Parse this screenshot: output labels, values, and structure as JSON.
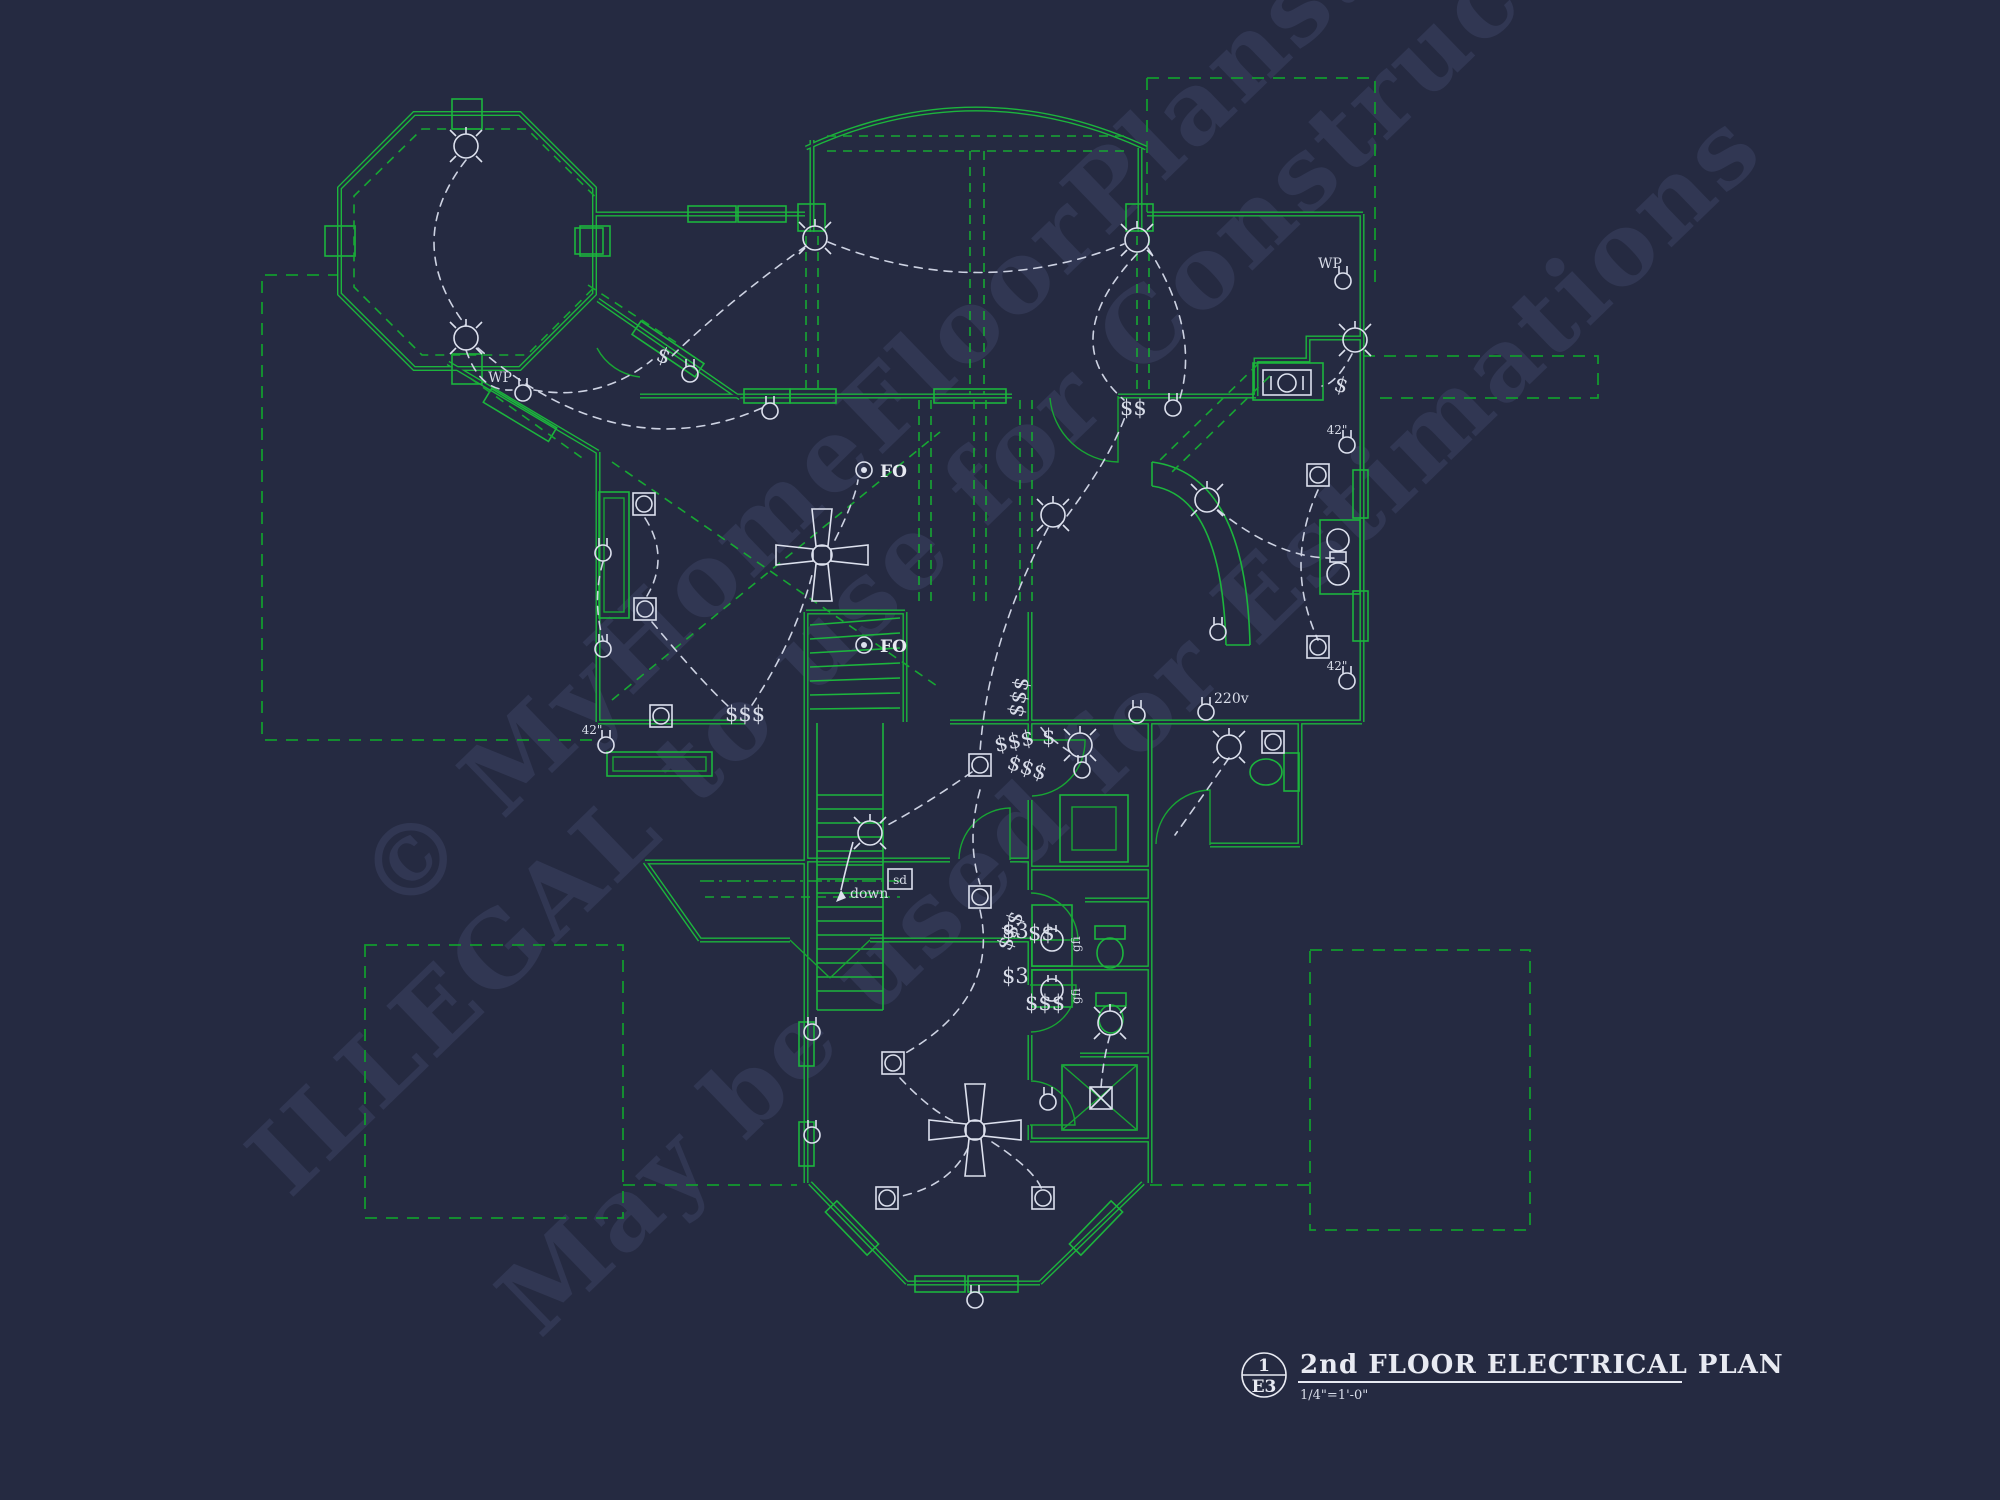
{
  "drawing": {
    "background_color": "#252a41",
    "wall_color": "#1cb53d",
    "ceiling_dash_color": "#17a833",
    "wiring_color": "#cdd2e2",
    "watermark_color": "#3b4262"
  },
  "title_block": {
    "detail_number": "1",
    "sheet_number": "E3",
    "title": "2nd FLOOR ELECTRICAL PLAN",
    "scale": "1/4\"=1'-0\""
  },
  "watermark": {
    "line1": "© MyHomeFloorPlans.com",
    "line2": "ILLEGAL to use for Construction",
    "line3": "May be used for Estimations"
  },
  "labels": {
    "stair_direction": "down",
    "smoke_detector": "sd",
    "future_outlet": "FO",
    "weatherproof_outlet": "WP",
    "gfci_outlet": "gfi",
    "counter_height_outlet": "42\"",
    "volt220_outlet": "220v",
    "switch_single": "$",
    "switch_double": "$$",
    "switch_triple": "$$$",
    "switch_three_way": "$3"
  }
}
